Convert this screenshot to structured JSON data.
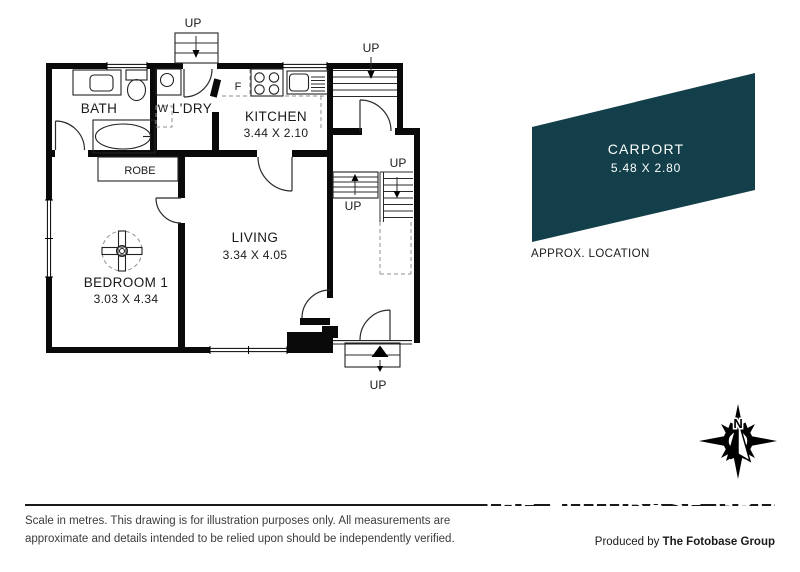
{
  "plan": {
    "rooms": {
      "bath": {
        "name": "BATH"
      },
      "laundry": {
        "name": "L'DRY"
      },
      "kitchen": {
        "name": "KITCHEN",
        "dims": "3.44 X 2.10"
      },
      "living": {
        "name": "LIVING",
        "dims": "3.34 X 4.05"
      },
      "bedroom1": {
        "name": "BEDROOM 1",
        "dims": "3.03 X 4.34"
      },
      "robe": {
        "name": "ROBE"
      }
    },
    "markers": {
      "washer": "W",
      "fridge": "F",
      "up": "UP"
    }
  },
  "carport": {
    "name": "CARPORT",
    "dims": "5.48 X 2.80",
    "note": "APPROX. LOCATION",
    "fill": "#123f4a"
  },
  "compass": {
    "north": "N"
  },
  "footer": {
    "disclaimer1": "Scale in metres. This drawing is for illustration purposes only. All measurements are",
    "disclaimer2": "approximate and details intended to be relied upon should be independently verified.",
    "credit_prefix": "Produced by ",
    "credit_brand": "The Fotobase Group",
    "watermark": "THE FOTOBASE GROUP"
  }
}
